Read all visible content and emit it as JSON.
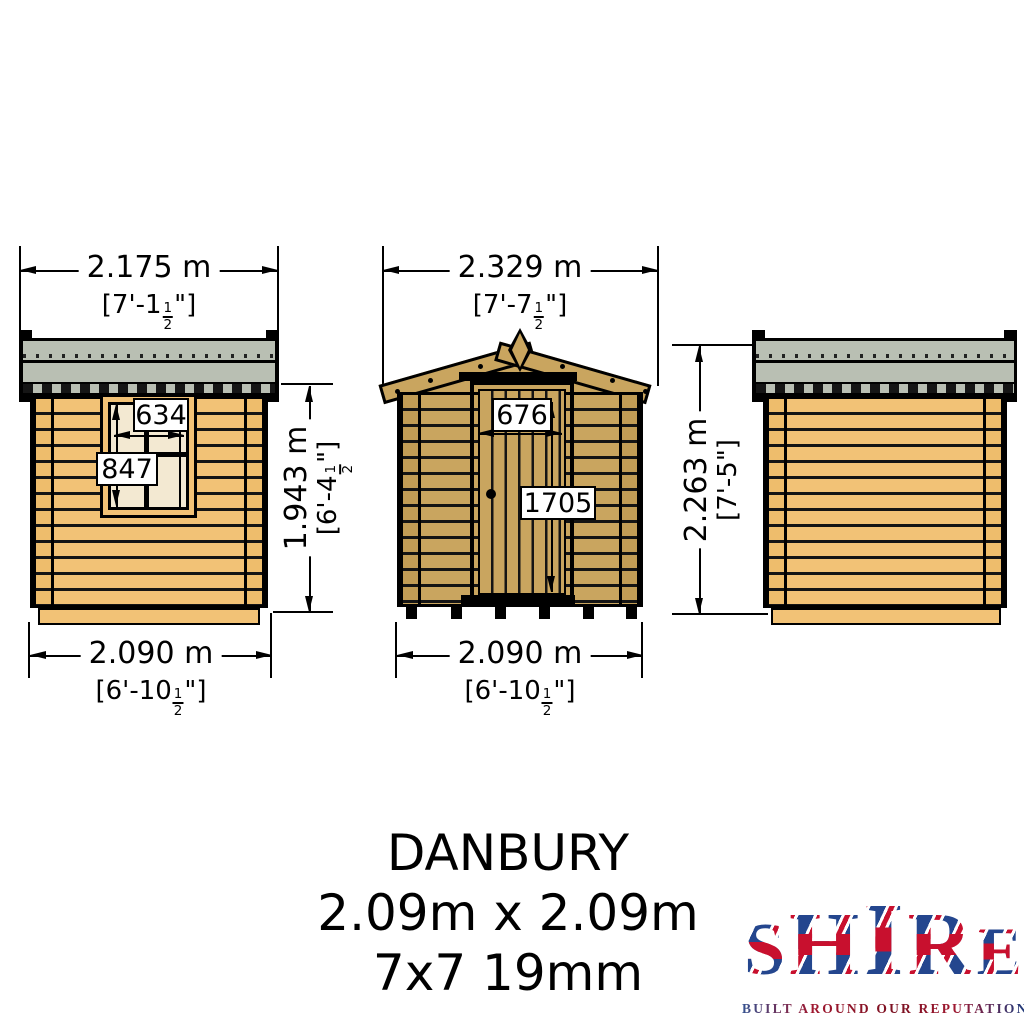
{
  "drawing": {
    "views": {
      "left": {
        "top_dim": {
          "metric": "2.175 m",
          "imp_pre": "[7'-1",
          "frac_n": "1",
          "frac_d": "2",
          "imp_post": "\"]"
        },
        "bottom_dim": {
          "metric": "2.090 m",
          "imp_pre": "[6'-10",
          "frac_n": "1",
          "frac_d": "2",
          "imp_post": "\"]"
        },
        "height_dim": {
          "metric": "1.943 m",
          "imp_pre": "[6'-4",
          "frac_n": "1",
          "frac_d": "2",
          "imp_post": "\"]"
        },
        "window": {
          "width_mm": "634",
          "height_mm": "847"
        }
      },
      "front": {
        "top_dim": {
          "metric": "2.329 m",
          "imp_pre": "[7'-7",
          "frac_n": "1",
          "frac_d": "2",
          "imp_post": "\"]"
        },
        "bottom_dim": {
          "metric": "2.090 m",
          "imp_pre": "[6'-10",
          "frac_n": "1",
          "frac_d": "2",
          "imp_post": "\"]"
        },
        "door": {
          "width_mm": "676",
          "height_mm": "1705"
        }
      },
      "right": {
        "height_dim": {
          "metric": "2.263 m",
          "imperial": "[7'-5\"]"
        }
      }
    },
    "title_block": {
      "model": "DANBURY",
      "footprint": "2.09m x 2.09m",
      "spec": "7x7 19mm"
    },
    "logo": {
      "letters": [
        "S",
        "H",
        "I",
        "R",
        "E"
      ],
      "tagline": "BUILT AROUND OUR REPUTATION"
    },
    "colors": {
      "side_wood": "#f2c276",
      "front_wood": "#c9a55f",
      "roof_felt": "#b9bfb3",
      "window_pane": "#f3e9d2",
      "outline": "#000000",
      "flag_red": "#c8102e",
      "flag_blue": "#24468e",
      "background": "#ffffff"
    }
  }
}
